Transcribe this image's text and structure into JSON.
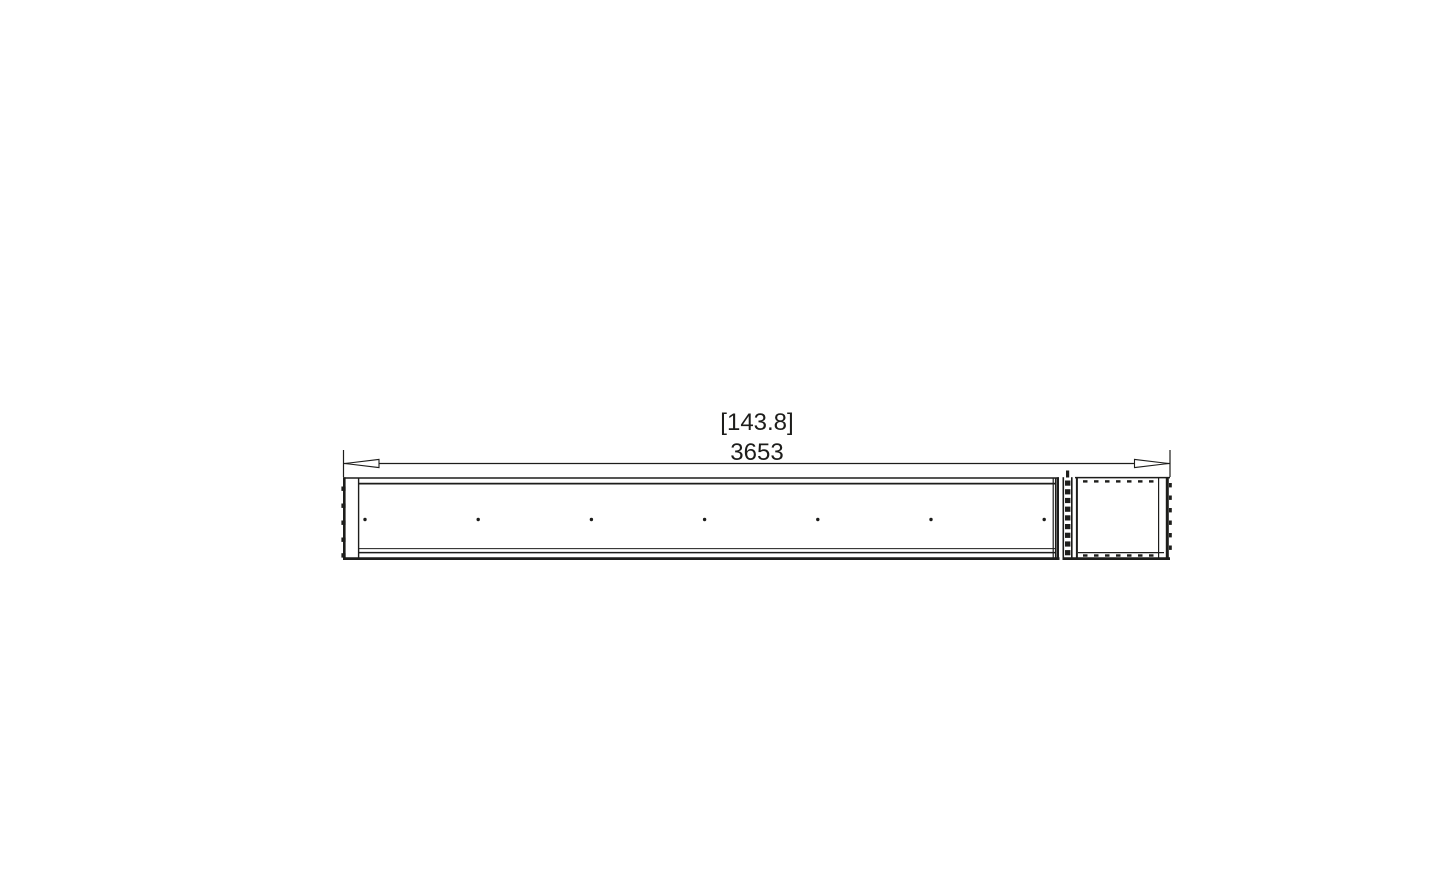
{
  "drawing": {
    "type": "technical-dimension-drawing",
    "view": "linear-burner-plan-view",
    "dimension": {
      "imperial_label": "[143.8]",
      "metric_label": "3653"
    },
    "colors": {
      "line": "#1d1d1b",
      "background": "#ffffff"
    },
    "counts": {
      "burner_port_dots": 7
    }
  }
}
